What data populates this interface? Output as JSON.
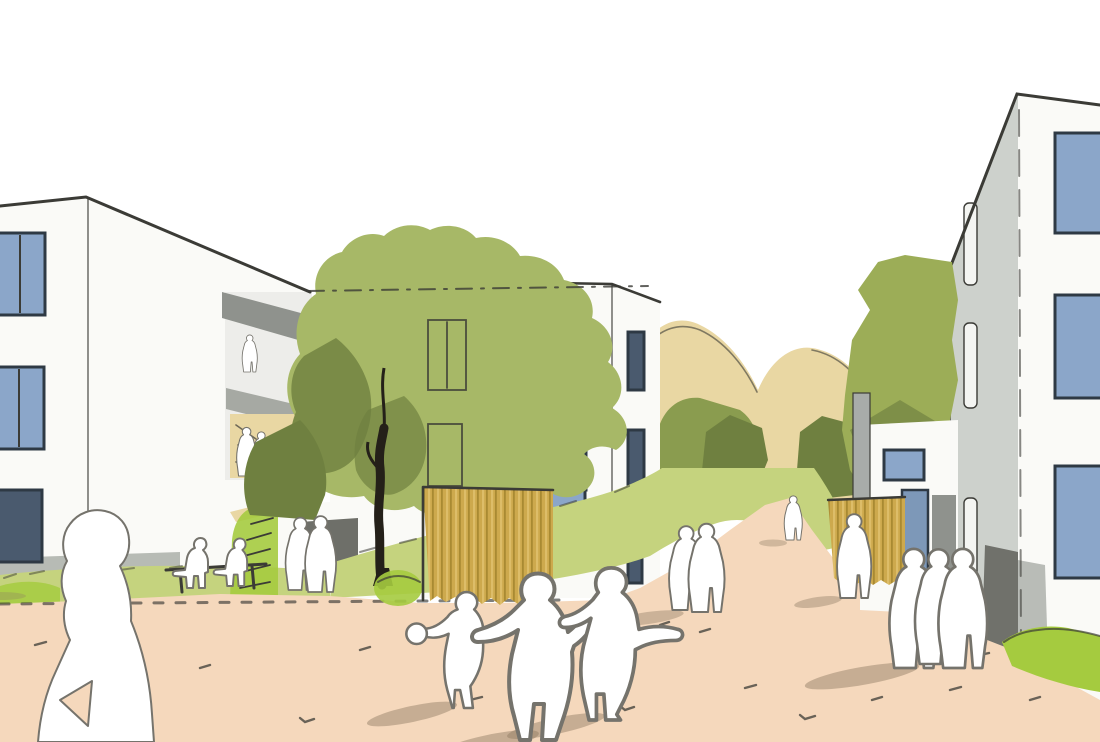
{
  "meta": {
    "title": "Architectural concept sketch - residential courtyard",
    "description": "Hand-drawn architectural visualization: three white multi-storey apartment buildings with blue windows around a peach-coloured pedestrian plaza, olive-green trees and tan hills behind, timber slat fences, and white human silhouettes - a woman in the foreground, children running, couples strolling and residents sitting on a bench."
  },
  "colors": {
    "paper": "#ffffff",
    "ink": "#3b3b36",
    "building_white": "#fafaf7",
    "building_shade": "#ededea",
    "facade_gray": "#cdd1cc",
    "slab_gray": "#8f928d",
    "slab_gray_light": "#a6a9a3",
    "base_gray": "#b7bbb5",
    "window_blue": "#8ba6c9",
    "window_blue_dark": "#4a5a6e",
    "window_frame": "#2e3944",
    "window_slit": "#f4f5f2",
    "door_dark": "#6e6f69",
    "door_blue": "#7d98b8",
    "entry_dark": "#70716b",
    "entry_gray": "#b9bcb7",
    "tree_olive": "#a7b867",
    "tree_olive2": "#9cad57",
    "tree_mid": "#8a9c4f",
    "tree_deep": "#6f8040",
    "hill_tan": "#e9d7a3",
    "grass_light": "#c5d37e",
    "grass_bright": "#a5cb3f",
    "fence_ochre": "#cda94d",
    "fence_ochre_dark": "#a98a32",
    "fence_ochre_light": "#ddbd69",
    "ground_peach": "#f5d8bc",
    "shadow_warm": "#8d7a62",
    "silhouette_white": "#ffffff",
    "silhouette_stroke": "#75736c",
    "trunk_dark": "#242019",
    "post_gray": "#a8aca9"
  },
  "scene": {
    "buildings": [
      {
        "name": "left apartment building",
        "visible_window_rows": 3
      },
      {
        "name": "center apartment building",
        "visible_window_rows": 3
      },
      {
        "name": "right apartment building",
        "visible_window_rows": 3
      }
    ],
    "vegetation": [
      "large olive tree at center",
      "tree at right building",
      "hillside shrubs",
      "meadow strips",
      "bright lawn tufts"
    ],
    "structures": [
      "timber slat fence center",
      "timber slat fence right",
      "bench",
      "stairs on green bank",
      "gray post"
    ],
    "figures": [
      "woman in foreground",
      "two people on bench",
      "couple at building entrance",
      "three children running",
      "couple on path",
      "person at right fence",
      "group of three residents",
      "sketched balcony figures"
    ]
  }
}
